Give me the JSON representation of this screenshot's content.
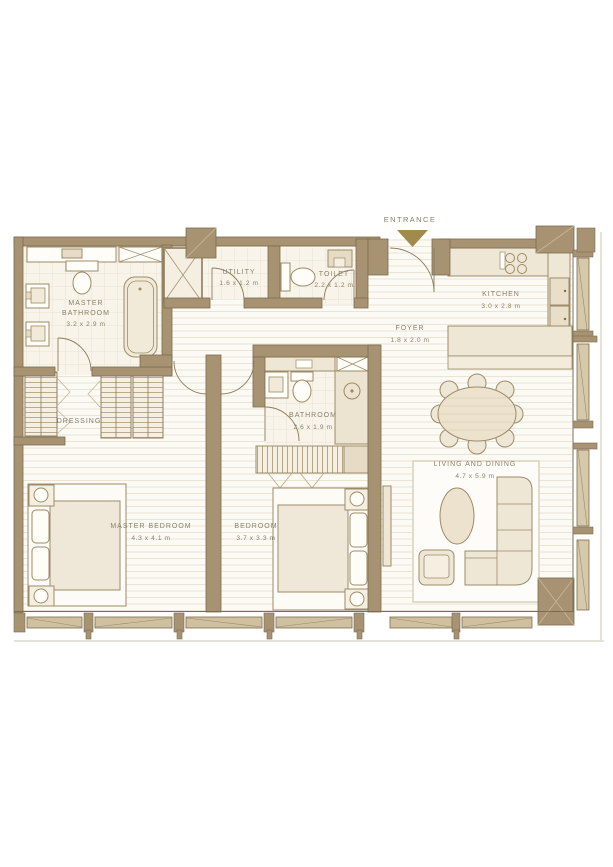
{
  "entrance": {
    "label": "ENTRANCE",
    "arrow_icon": "triangle-down"
  },
  "rooms": {
    "master_bathroom": {
      "line1": "MASTER",
      "line2": "BATHROOM",
      "dims": "3.2 x 2.9 m"
    },
    "utility": {
      "name": "UTILITY",
      "dims": "1.6 x 1.2 m"
    },
    "toilet": {
      "name": "TOILET",
      "dims": "2.2 x 1.2 m"
    },
    "kitchen": {
      "name": "KITCHEN",
      "dims": "3.0 x 2.8 m"
    },
    "foyer": {
      "name": "FOYER",
      "dims": "1.8 x 2.0 m"
    },
    "dressing": {
      "name": "DRESSING"
    },
    "bathroom": {
      "name": "BATHROOM",
      "dims": "2.6 x 1.9 m"
    },
    "master_bedroom": {
      "name": "MASTER BEDROOM",
      "dims": "4.3 x 4.1 m"
    },
    "bedroom": {
      "name": "BEDROOM",
      "dims": "3.7 x 3.3 m"
    },
    "living_dining": {
      "name": "LIVING AND DINING",
      "dims": "4.7 x 5.9 m"
    }
  },
  "colors": {
    "wall": "#a79372",
    "wall_dark": "#7d6c4f",
    "floor_plank": "#fcfaf5",
    "floor_tile": "#f8f4ea",
    "furniture_cream": "#efe7d6",
    "furniture_deep": "#e3d7bd",
    "label_text": "#8b8069",
    "entrance_gold": "#a18a4b"
  }
}
